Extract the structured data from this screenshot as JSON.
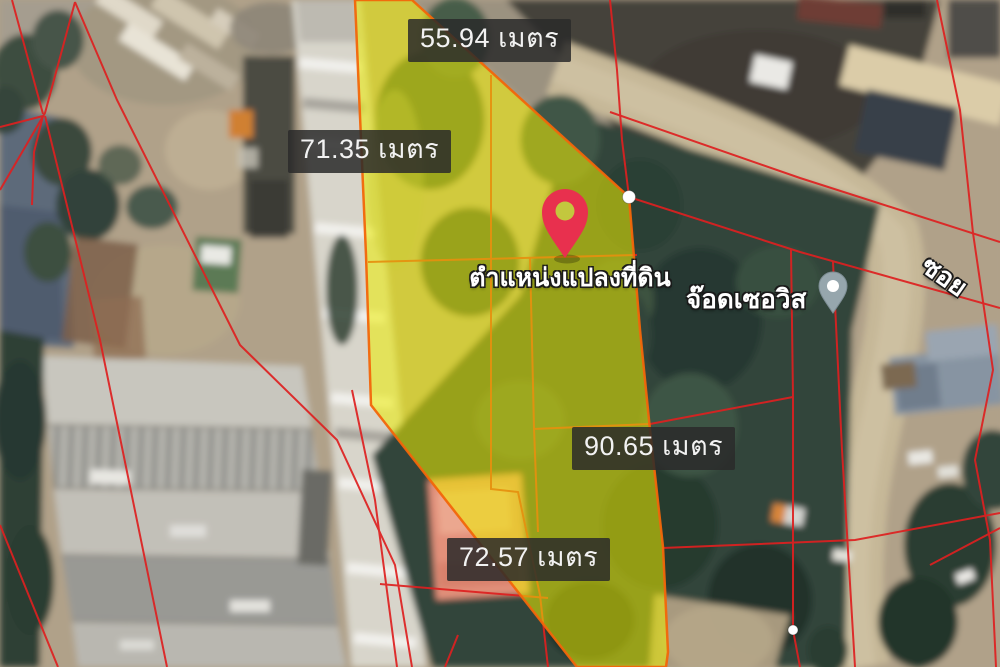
{
  "map": {
    "title": "Land parcel satellite map",
    "measurement_unit": "เมตร",
    "measurements": [
      {
        "side": "top",
        "value": "55.94",
        "text": "55.94 เมตร"
      },
      {
        "side": "left",
        "value": "71.35",
        "text": "71.35 เมตร"
      },
      {
        "side": "right",
        "value": "90.65",
        "text": "90.65 เมตร"
      },
      {
        "side": "bottom",
        "value": "72.57",
        "text": "72.57 เมตร"
      }
    ],
    "marker_caption": "ตำแหน่งแปลงที่ดิน",
    "place_label": "จ๊อดเซอวิส",
    "road_label": "ซอย",
    "colors": {
      "parcel_fill": "#ECEC00",
      "parcel_outline": "#F2660A",
      "cadastral_line": "#DE2020",
      "marker_red": "#E8304E",
      "place_marker_gray": "#96A6AD",
      "label_background": "#2A2A2A",
      "label_text": "#F2F2F2"
    }
  }
}
